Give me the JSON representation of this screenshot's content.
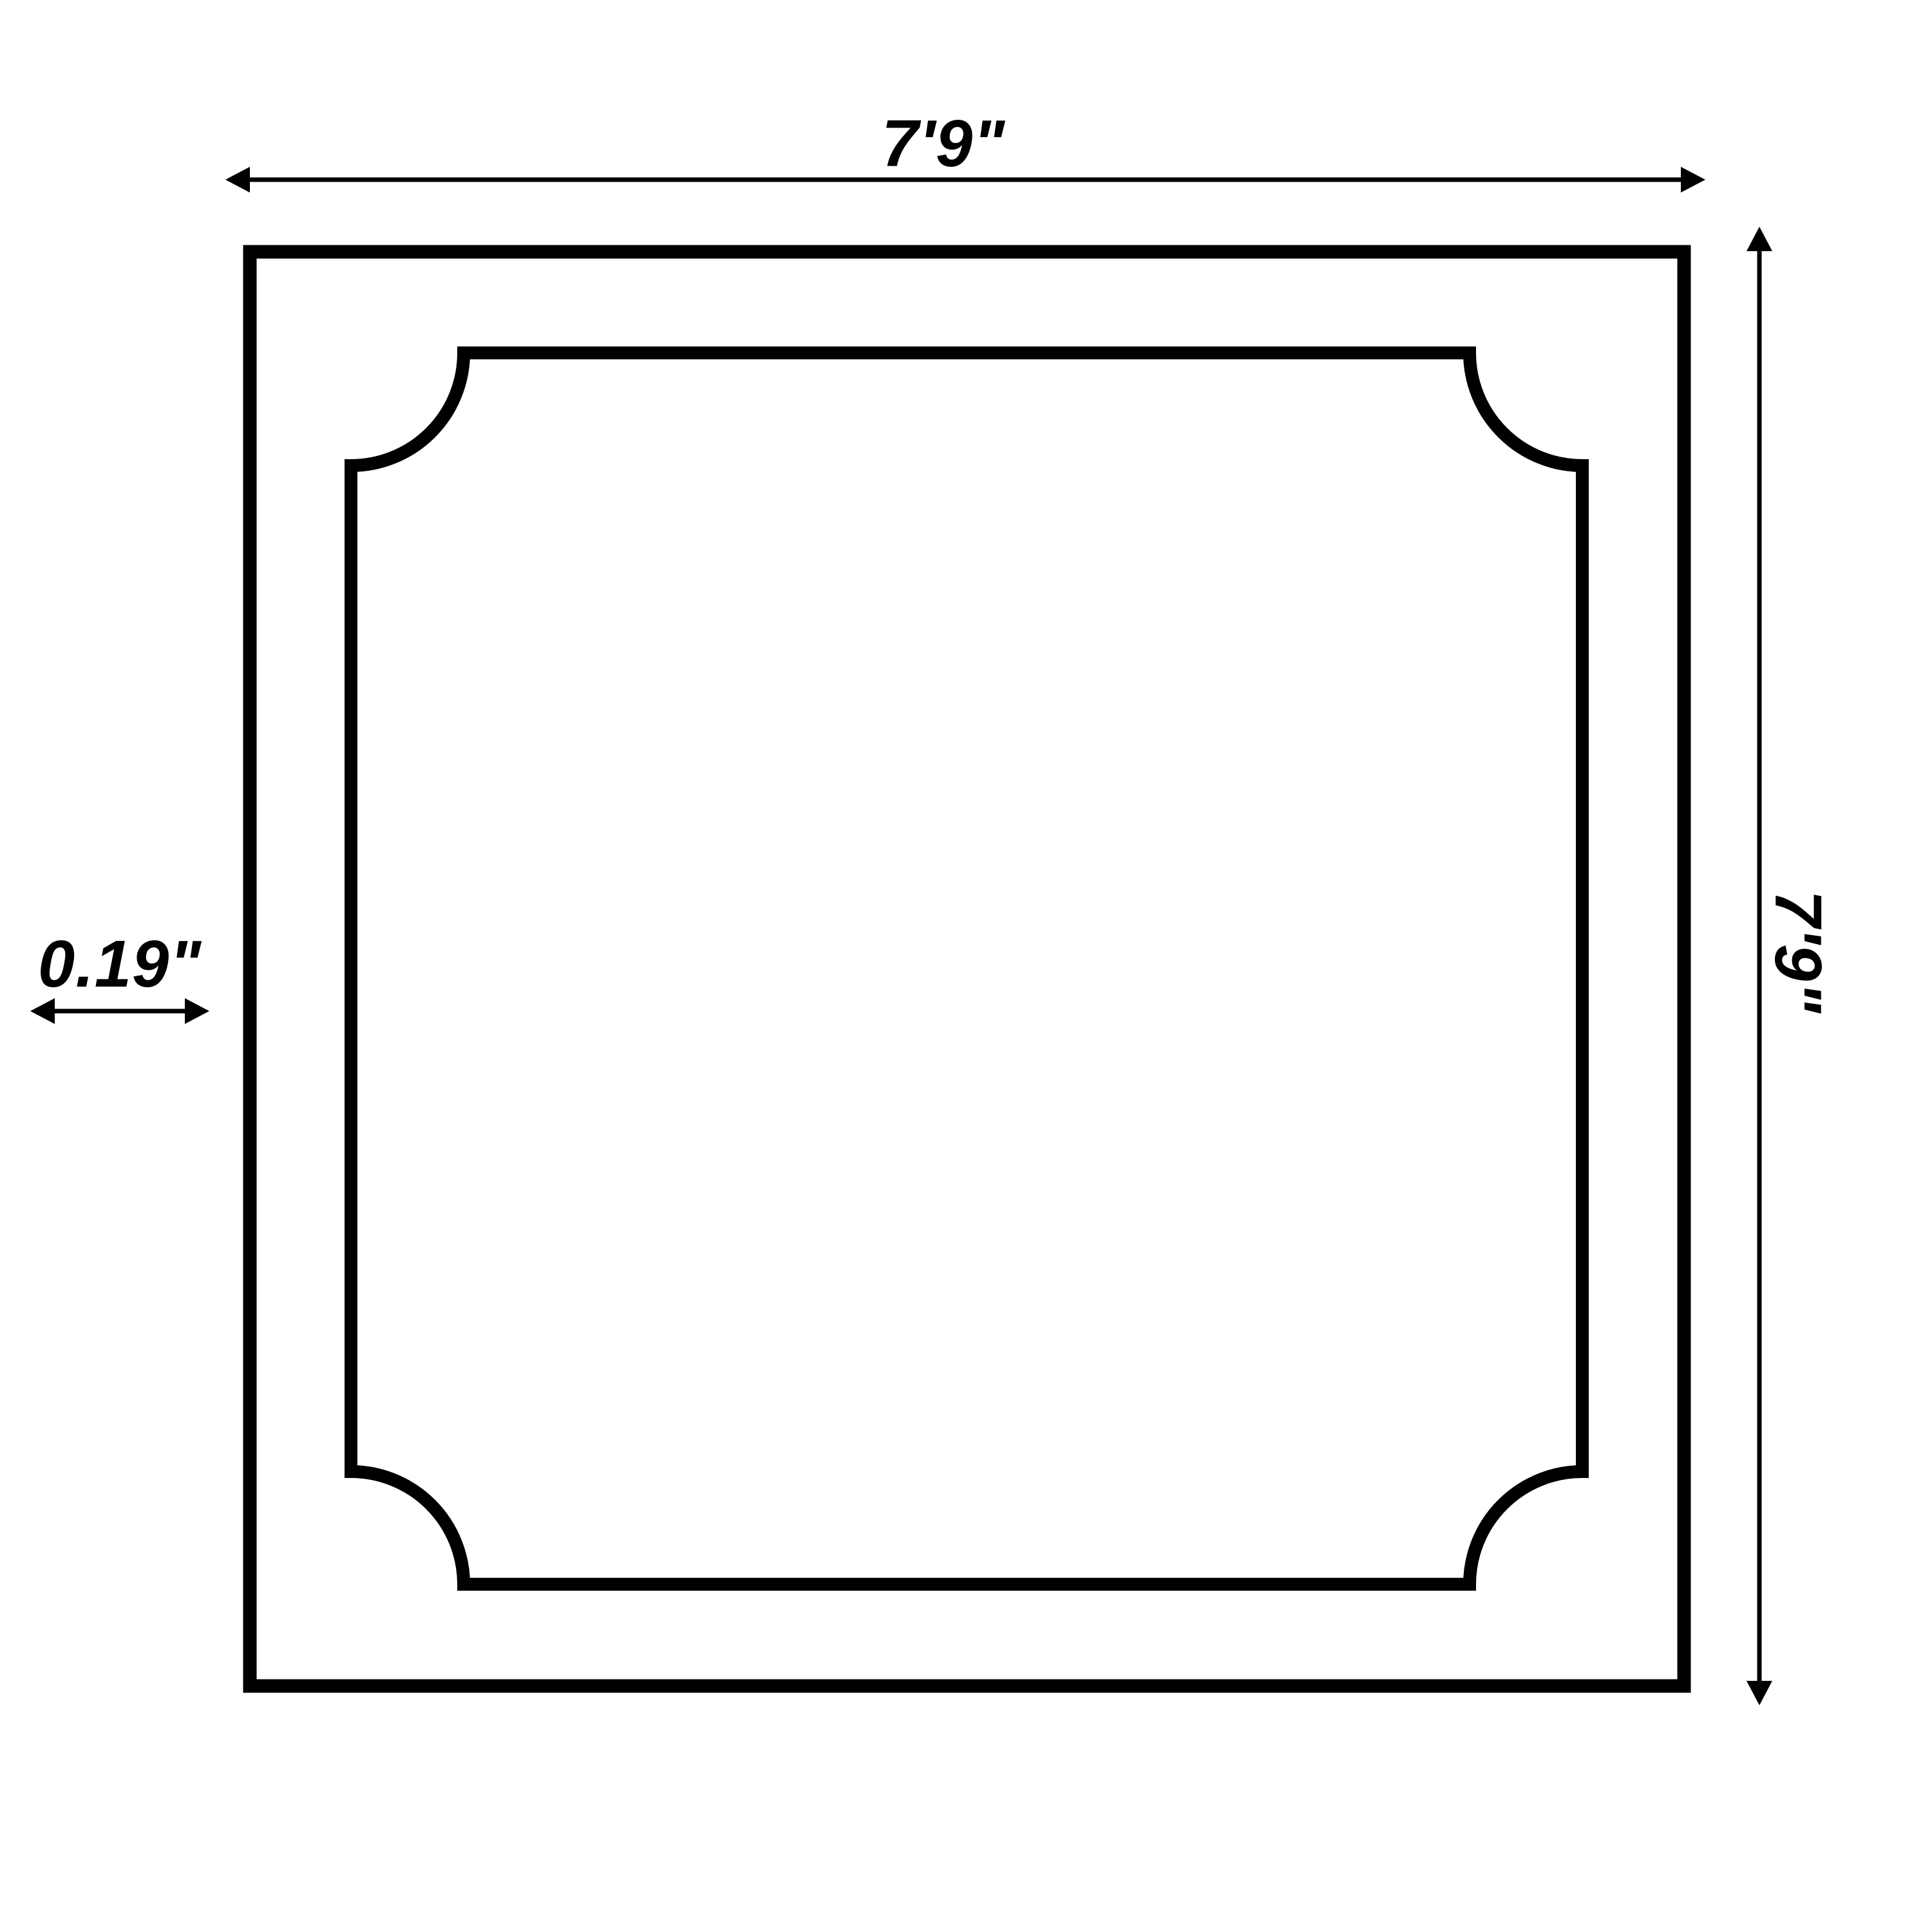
{
  "diagram": {
    "type": "panel-dimension-drawing",
    "shape": "square ceiling panel with scooped-corner inner moulding"
  },
  "labels": {
    "top_width": "7'9\"",
    "right_height": "7'9\"",
    "left_thickness": "0.19\""
  },
  "colors": {
    "ink": "#000000",
    "background": "#ffffff"
  }
}
